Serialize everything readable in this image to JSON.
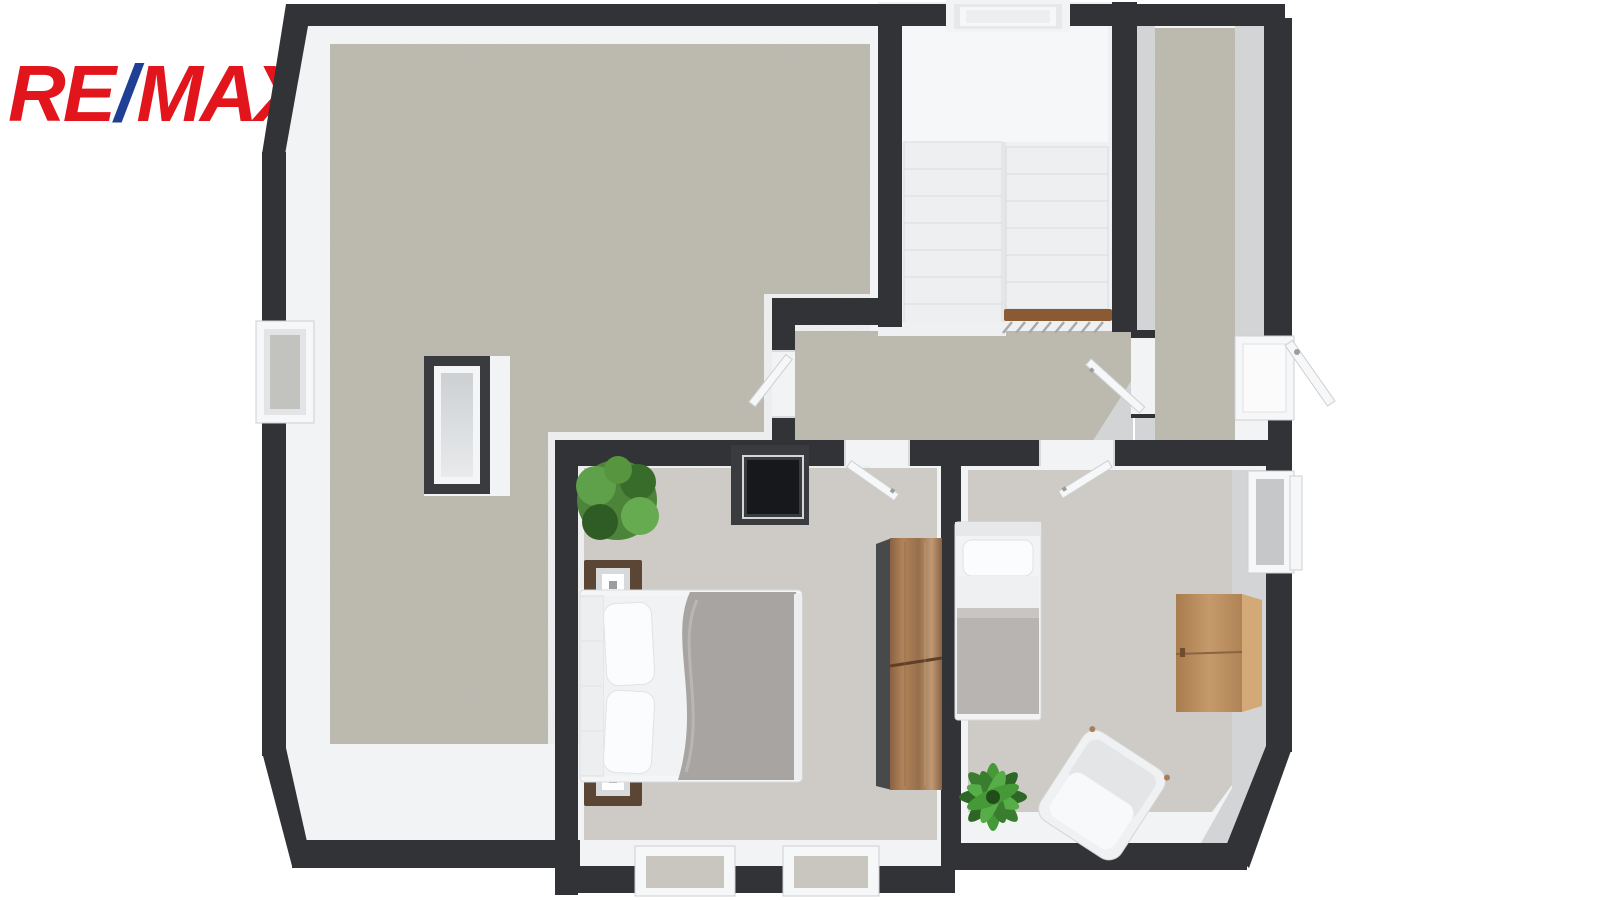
{
  "logo": {
    "part1": "RE",
    "slash": "/",
    "part2": "MAX"
  },
  "palette": {
    "brand-red": "#e2151c",
    "brand-blue": "#1e3f94",
    "wall": "#323337",
    "band": "#f2f3f4",
    "band-gray": "#d3d4d6",
    "floor-main": "#bdbab0",
    "floor-bed": "#cecac5",
    "stair-landing": "#f6f7f9",
    "stair-room": "#eef0f2",
    "rail-wood": "#8a5a33",
    "wardrobe-wood": "#a97e58",
    "dresser-wood": "#c09465",
    "duvet-gray": "#a8a4a1",
    "blanket-gray": "#b7b4b1",
    "chimney-black": "#17181b",
    "plant-green": "#458a36"
  },
  "plan": {
    "type": "3d-top-down-floor-plan",
    "floor": "attic-level",
    "rooms": [
      {
        "id": "attic-open-space",
        "floor_finish": "concrete-gray",
        "features": [
          "roof-window-left-wall",
          "skylight-shaft-box",
          "door-to-hall"
        ]
      },
      {
        "id": "staircase",
        "features": [
          "u-shaped-stair",
          "two-flights",
          "upper-landing",
          "wood-handrail",
          "skylight-over-stairs"
        ],
        "steps_per_flight": 7
      },
      {
        "id": "hall-landing",
        "floor_finish": "concrete-gray",
        "features": [
          "door-to-attic-space",
          "door-to-bedroom-large",
          "door-to-bedroom-small",
          "door-to-loft-room"
        ]
      },
      {
        "id": "loft-room",
        "floor_finish": "concrete-gray",
        "features": [
          "sloped-ceiling-bands",
          "end-window-open-casement"
        ]
      },
      {
        "id": "bedroom-large",
        "floor_finish": "smooth-gray",
        "furniture": [
          "double-bed",
          "nightstand-with-lamp-top",
          "nightstand-with-lamp-bottom",
          "potted-plant",
          "wardrobe",
          "chimney-shaft"
        ],
        "windows": [
          "roof-window-bottom-1",
          "roof-window-bottom-2"
        ]
      },
      {
        "id": "bedroom-small",
        "floor_finish": "smooth-gray",
        "furniture": [
          "single-bed",
          "dresser",
          "armchair",
          "potted-plant"
        ],
        "windows": [
          "side-window-open"
        ],
        "features": [
          "chamfered-corner"
        ]
      }
    ]
  }
}
